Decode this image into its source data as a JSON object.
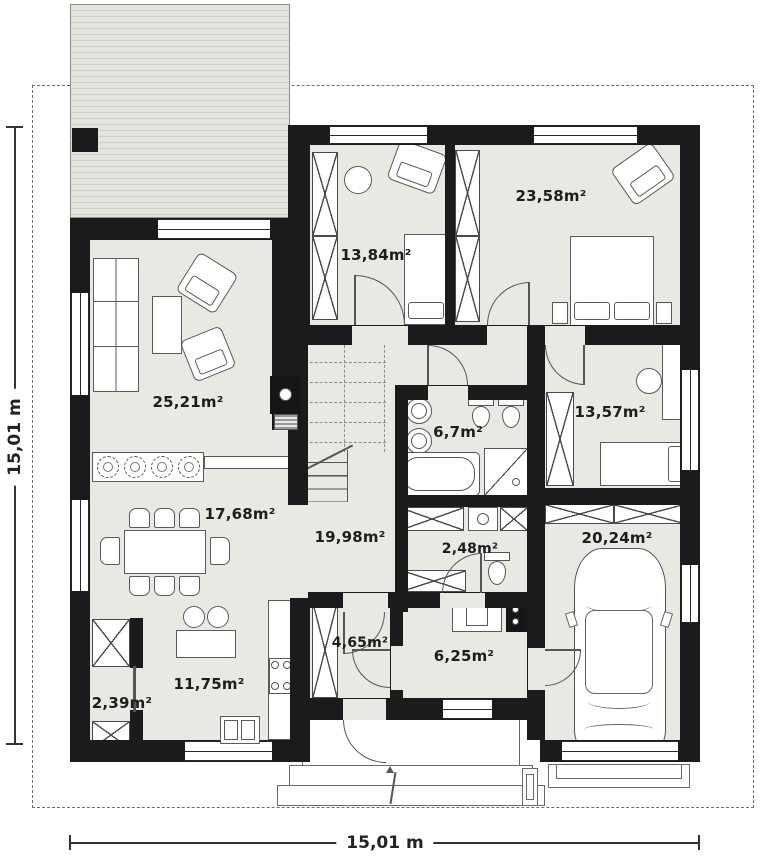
{
  "plan": {
    "dimensions": {
      "left_label": "15,01 m",
      "bottom_label": "15,01 m"
    },
    "rooms": [
      {
        "name": "living-room",
        "area": "25,21m²"
      },
      {
        "name": "dining-area",
        "area": "17,68m²"
      },
      {
        "name": "kitchen",
        "area": "11,75m²"
      },
      {
        "name": "pantry",
        "area": "2,39m²"
      },
      {
        "name": "hall",
        "area": "19,98m²"
      },
      {
        "name": "bathroom",
        "area": "6,7m²"
      },
      {
        "name": "toilet",
        "area": "2,48m²"
      },
      {
        "name": "bedroom-1",
        "area": "13,84m²"
      },
      {
        "name": "bedroom-2",
        "area": "23,58m²"
      },
      {
        "name": "bedroom-3",
        "area": "13,57m²"
      },
      {
        "name": "entry-hall",
        "area": "4,65m²"
      },
      {
        "name": "utility-room",
        "area": "6,25m²"
      },
      {
        "name": "garage",
        "area": "20,24m²"
      }
    ],
    "colors": {
      "wall": "#1b1b1b",
      "floor": "#e9e8e2",
      "accent_line": "#555555"
    }
  }
}
